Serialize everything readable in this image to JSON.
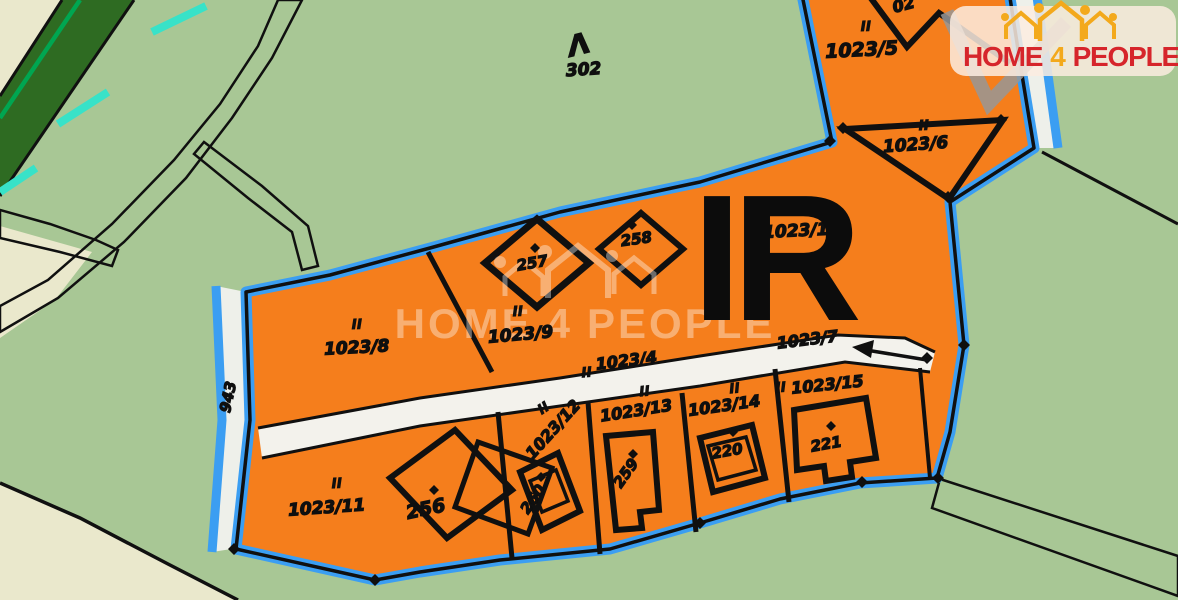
{
  "logo": {
    "home": "HOME",
    "four": "4",
    "people": "PEOPLE"
  },
  "watermark": {
    "home": "HOME",
    "four": "4",
    "people": "PEOPLE"
  },
  "map": {
    "overlay": "IR",
    "roman_mark": "II",
    "parcel_labels": [
      {
        "text": "1023/5",
        "x": 862,
        "y": 56,
        "rot": -3,
        "size": 19,
        "roman": [
          866,
          31
        ]
      },
      {
        "text": "1023/6",
        "x": 916,
        "y": 150,
        "rot": -4,
        "size": 17,
        "roman": [
          924,
          130
        ]
      },
      {
        "text": "1023/10",
        "x": 802,
        "y": 236,
        "rot": -3,
        "size": 17,
        "roman": [
          798,
          214
        ]
      },
      {
        "text": "1023/8",
        "x": 357,
        "y": 353,
        "rot": -3,
        "size": 17,
        "roman": [
          357,
          329
        ]
      },
      {
        "text": "1023/9",
        "x": 521,
        "y": 340,
        "rot": -5,
        "size": 17,
        "roman": [
          518,
          316
        ]
      },
      {
        "text": "1023/4",
        "x": 627,
        "y": 366,
        "rot": -7,
        "size": 16,
        "roman": [
          587,
          377
        ]
      },
      {
        "text": "1023/7",
        "x": 808,
        "y": 345,
        "rot": -7,
        "size": 16,
        "roman": null
      },
      {
        "text": "1023/15",
        "x": 828,
        "y": 390,
        "rot": -6,
        "size": 16,
        "roman": [
          781,
          392
        ]
      },
      {
        "text": "1023/11",
        "x": 327,
        "y": 513,
        "rot": -4,
        "size": 17,
        "roman": [
          337,
          488
        ]
      },
      {
        "text": "1023/12",
        "x": 557,
        "y": 433,
        "rot": -48,
        "size": 16,
        "roman": [
          546,
          412
        ]
      },
      {
        "text": "1023/13",
        "x": 637,
        "y": 416,
        "rot": -9,
        "size": 16,
        "roman": [
          645,
          396
        ]
      },
      {
        "text": "1023/14",
        "x": 725,
        "y": 411,
        "rot": -8,
        "size": 16,
        "roman": [
          735,
          393
        ]
      },
      {
        "text": "02",
        "x": 905,
        "y": 10,
        "rot": -15,
        "size": 16,
        "roman": null
      }
    ],
    "building_labels": [
      {
        "text": "257",
        "x": 533,
        "y": 268,
        "rot": -10,
        "size": 15,
        "dot": [
          535,
          248
        ]
      },
      {
        "text": "258",
        "x": 637,
        "y": 244,
        "rot": -8,
        "size": 15,
        "dot": [
          632,
          225
        ]
      },
      {
        "text": "256",
        "x": 427,
        "y": 515,
        "rot": -12,
        "size": 19,
        "dot": [
          434,
          490
        ]
      },
      {
        "text": "260",
        "x": 537,
        "y": 502,
        "rot": -55,
        "size": 15,
        "dot": [
          541,
          477
        ]
      },
      {
        "text": "259",
        "x": 630,
        "y": 476,
        "rot": -55,
        "size": 15,
        "dot": [
          633,
          454
        ]
      },
      {
        "text": "220",
        "x": 728,
        "y": 456,
        "rot": -10,
        "size": 15,
        "dot": [
          733,
          432
        ]
      },
      {
        "text": "221",
        "x": 827,
        "y": 449,
        "rot": -10,
        "size": 15,
        "dot": [
          831,
          426
        ]
      }
    ],
    "misc_labels": [
      {
        "text": "302",
        "x": 584,
        "y": 75,
        "rot": -4,
        "size": 17
      },
      {
        "text": "943",
        "x": 233,
        "y": 398,
        "rot": -78,
        "size": 15
      },
      {
        "text": "Λ",
        "x": 581,
        "y": 54,
        "rot": -14,
        "size": 28
      }
    ]
  },
  "colors": {
    "orange": "#f57e1c",
    "border_blue": "#3b9ef2",
    "bg_green": "#a8c795",
    "band_green": "#2e6b22",
    "tan": "#eae8cc",
    "road_white": "#f3f2ec",
    "cyan": "#38e2c8",
    "bright_green": "#00a651",
    "logo_red": "#d6252b",
    "logo_gold": "#f3a91c",
    "ink": "#101010"
  }
}
